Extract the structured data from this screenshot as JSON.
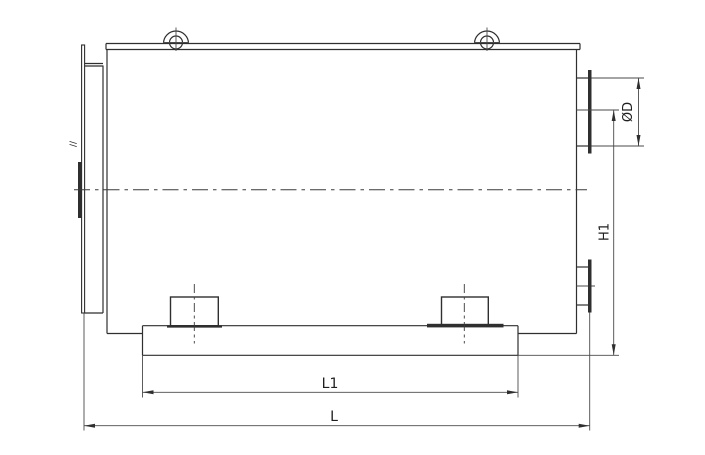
{
  "drawing": {
    "background_color": "#ffffff",
    "line_color": "#2f2f2f",
    "labels": {
      "nozzle_diameter": "ØD",
      "mount_height": "H1",
      "base_length": "L1",
      "overall_length": "L",
      "left_plate_mark": "//"
    }
  }
}
